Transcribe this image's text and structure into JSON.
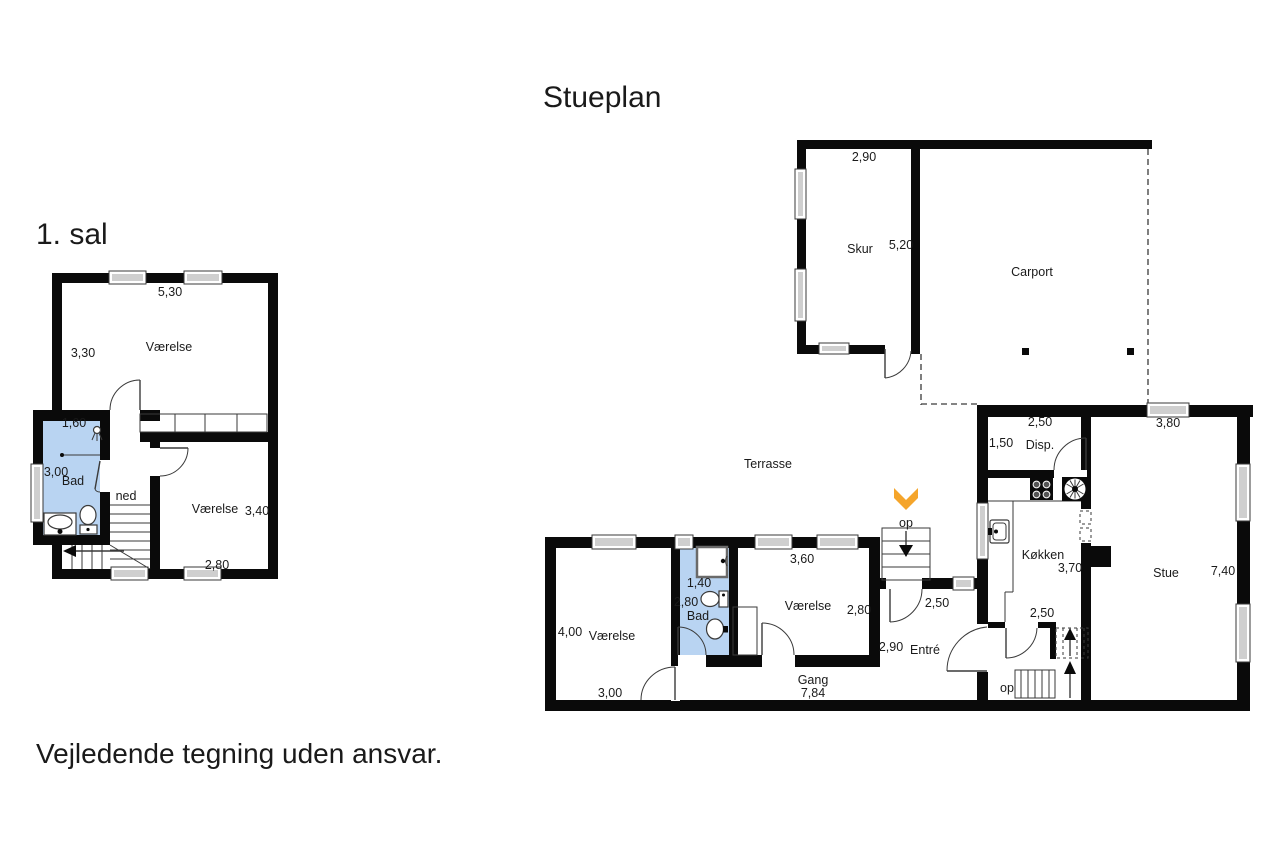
{
  "colors": {
    "bg": "#ffffff",
    "wall": "#0a0a0a",
    "line": "#3a3a3a",
    "bath": "#b9d4f2",
    "window_pane": "#cfcfcf",
    "orange": "#f5a52b",
    "text": "#1a1a1a"
  },
  "titles": {
    "first_floor": "1. sal",
    "ground_floor": "Stueplan",
    "disclaimer": "Vejledende tegning uden ansvar."
  },
  "first_floor": {
    "labels": {
      "room1_width": "5,30",
      "room1_name": "Værelse",
      "room1_height": "3,30",
      "bath_width": "1,60",
      "bath_height": "3,00",
      "bath_name": "Bad",
      "stairs_down": "ned",
      "room2_name": "Værelse",
      "room2_height": "3,40",
      "room2_width": "2,80"
    }
  },
  "ground_floor": {
    "labels": {
      "shed_width": "2,90",
      "shed_name": "Skur",
      "shed_depth": "5,20",
      "carport_name": "Carport",
      "terrace_name": "Terrasse",
      "outdoor_stairs": "op",
      "room1_height": "4,00",
      "room1_name": "Værelse",
      "room1_width": "3,00",
      "bath_width": "1,40",
      "bath_height": "2,80",
      "bath_name": "Bad",
      "room2_width": "3,60",
      "room2_name": "Værelse",
      "room2_height": "2,80",
      "hall_name": "Gang",
      "hall_length": "7,84",
      "entry_width": "2,50",
      "entry_height": "2,90",
      "entry_name": "Entré",
      "kitchen_name": "Køkken",
      "kitchen_depth": "3,70",
      "kitchen_width": "2,50",
      "indoor_stairs": "op",
      "pantry_width": "2,50",
      "pantry_height": "1,50",
      "pantry_name": "Disp.",
      "living_width": "3,80",
      "living_name": "Stue",
      "living_height": "7,40"
    }
  }
}
